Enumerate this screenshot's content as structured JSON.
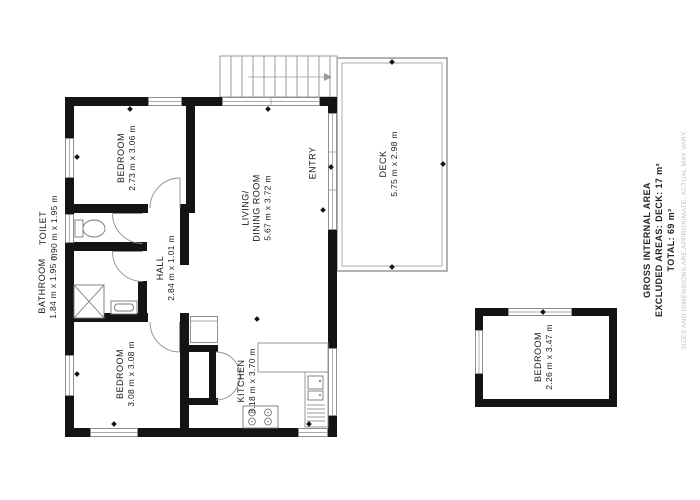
{
  "rooms": {
    "bedroom_top": {
      "name": "BEDROOM",
      "dims": "2.73 m x 3.06 m"
    },
    "toilet": {
      "name": "TOILET",
      "dims": "0.90 m x 1.95 m"
    },
    "bathroom": {
      "name": "BATHROOM",
      "dims": "1.84 m x 1.95 m"
    },
    "hall": {
      "name": "HALL",
      "dims": "2.84 m x 1.01 m"
    },
    "living_dining": {
      "name_line1": "LIVING/",
      "name_line2": "DINING ROOM",
      "dims": "5.67 m x 3.72 m"
    },
    "entry": {
      "name": "ENTRY"
    },
    "bedroom_bottom": {
      "name": "BEDROOM",
      "dims": "3.08 m x 3.08 m"
    },
    "kitchen": {
      "name": "KITCHEN",
      "dims": "3.18 m x 3.70 m"
    },
    "deck": {
      "name": "DECK",
      "dims": "5.75 m x 2.98 m"
    },
    "bedroom_separate": {
      "name": "BEDROOM",
      "dims": "2.26 m x 3.47 m"
    }
  },
  "area_summary": {
    "line1": "GROSS INTERNAL AREA",
    "line2": "EXCLUDED AREAS: DECK: 17 m²",
    "line3": "TOTAL: 69 m²",
    "disclaimer": "SIZES AND DIMENSIONS ARE APPROXIMATE, ACTUAL MAY VARY."
  },
  "colors": {
    "background": "#ffffff",
    "wall": "#141414",
    "window_stroke": "#8f8f8f",
    "fixture_stroke": "#777777",
    "deck_stroke": "#9a9a9a",
    "label_text": "#1a1a1a",
    "disclaimer_text": "#bdbdbd"
  }
}
